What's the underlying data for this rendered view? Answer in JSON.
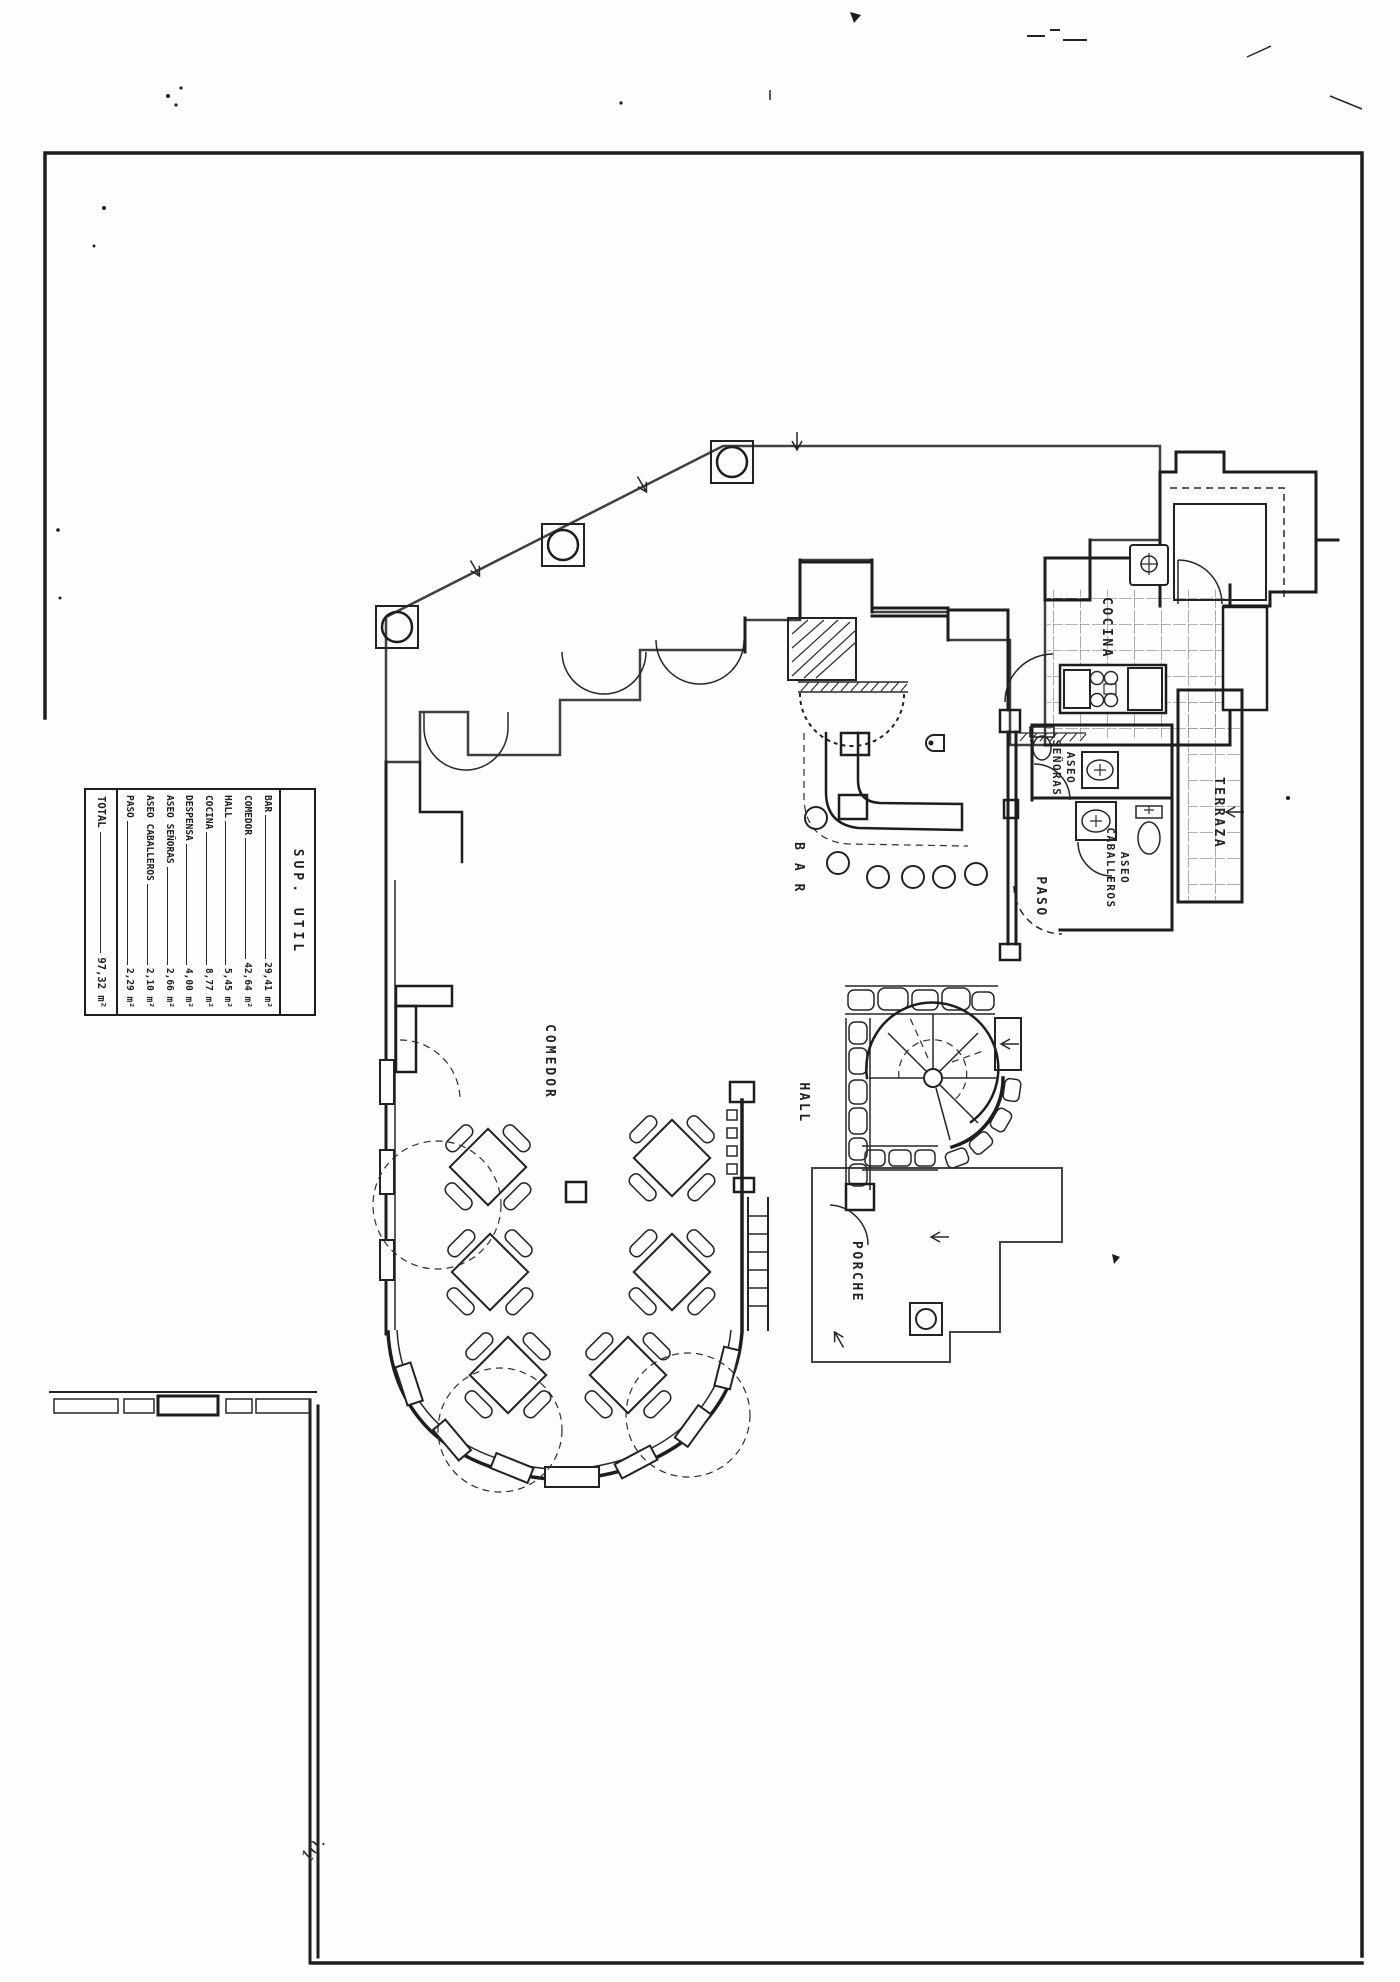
{
  "legend": {
    "title": "SUP. UTIL",
    "rows": [
      {
        "label": "BAR",
        "value": "29,41 m²"
      },
      {
        "label": "COMEDOR",
        "value": "42,64 m²"
      },
      {
        "label": "HALL",
        "value": "5,45 m²"
      },
      {
        "label": "COCINA",
        "value": "8,77 m²"
      },
      {
        "label": "DESPENSA",
        "value": "4,00 m²"
      },
      {
        "label": "ASEO SEÑORAS",
        "value": "2,66 m²"
      },
      {
        "label": "ASEO CABALLEROS",
        "value": "2,10 m²"
      },
      {
        "label": "PASO",
        "value": "2,29 m²"
      }
    ],
    "total": {
      "label": "TOTAL",
      "value": "97,32 m²"
    }
  },
  "room_labels": {
    "comedor": "COMEDOR",
    "bar": "B A R",
    "hall": "HALL",
    "porche": "PORCHE",
    "cocina": "COCINA",
    "terraza": "TERRAZA",
    "paso": "PASO",
    "aseo_senoras": {
      "line1": "ASEO",
      "line2": "SEÑORAS"
    },
    "aseo_caballeros": {
      "line1": "ASEO",
      "line2": "CABALLEROS"
    }
  },
  "annotations": {
    "handwritten_mark": "10."
  },
  "colors": {
    "paper": "#fdfdfb",
    "ink": "#1d1d1d",
    "tile_line": "#3f3f3f"
  }
}
